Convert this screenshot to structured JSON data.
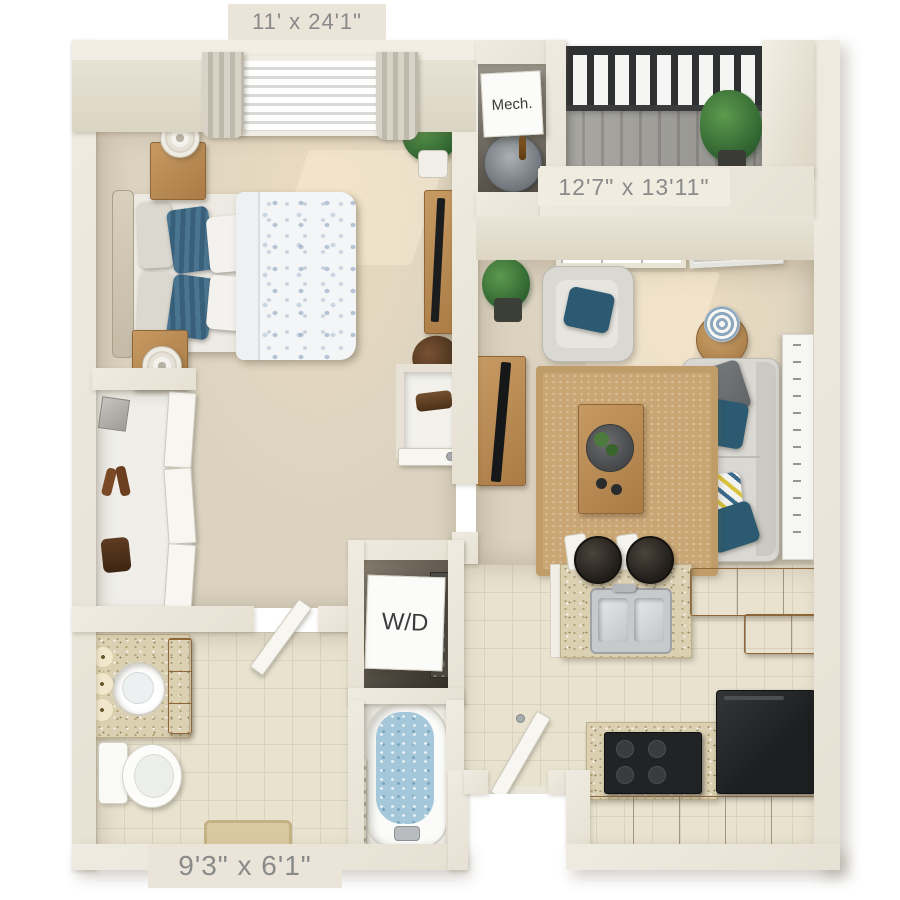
{
  "floorplan": {
    "view": "3D top-down apartment floor plan rendering",
    "dimension_labels": {
      "bedroom": "11' x 24'1\"",
      "living_room": "12'7\" x 13'11\"",
      "bathroom": "9'3\" x 6'1\""
    },
    "room_placards": {
      "mechanical": "Mech.",
      "laundry": "W/D"
    },
    "rooms": [
      {
        "name": "bedroom",
        "furniture": [
          "bed-with-floral-duvet",
          "blue-striped-pillows",
          "headboard",
          "nightstand-with-lamp",
          "second-nightstand-with-lamp",
          "dresser-with-tv",
          "accent-chair",
          "potted-plant",
          "window-with-curtains-and-blinds"
        ]
      },
      {
        "name": "walk-in-closet",
        "furniture": [
          "shelf-with-box",
          "shoes",
          "bag",
          "bifold-doors"
        ]
      },
      {
        "name": "mechanical-closet",
        "furniture": [
          "water-heater"
        ]
      },
      {
        "name": "balcony",
        "furniture": [
          "metal-railing",
          "plank-deck",
          "potted-palm"
        ]
      },
      {
        "name": "living-room",
        "furniture": [
          "window",
          "louvered-hvac-door",
          "armchair-with-teal-pillow",
          "round-side-table-with-lamp",
          "sofa-with-pillows",
          "wall-art-panel",
          "jute-area-rug",
          "coffee-table-with-tray",
          "tv-console-with-tv",
          "potted-bush"
        ]
      },
      {
        "name": "kitchen",
        "furniture": [
          "granite-peninsula-with-double-sink",
          "two-bar-stools",
          "upper-cabinets",
          "black-range",
          "black-refrigerator",
          "base-cabinets"
        ]
      },
      {
        "name": "laundry-closet",
        "furniture": [
          "stacked-washer-dryer"
        ]
      },
      {
        "name": "bathroom",
        "furniture": [
          "granite-vanity-with-round-sink",
          "candles",
          "toilet",
          "bath-mat",
          "bathtub-with-water",
          "shower-curtain",
          "door"
        ]
      },
      {
        "name": "entry",
        "furniture": [
          "front-door"
        ]
      }
    ],
    "colors": {
      "background": "#ffffff",
      "walls": "#eae5d9",
      "carpet": "#dbd2c0",
      "tile": "#e8e2cf",
      "closet_floor": "#efeee8",
      "balcony_deck": "#a3a29e",
      "railing": "#2f3032",
      "wood": "#bd8c51",
      "granite": "#dbd0b2",
      "sofa": "#dad8d3",
      "pillow_blue": "#47718e",
      "pillow_teal": "#2b5a71",
      "rug": "#c9a674",
      "bath_water": "#a4c8da",
      "appliance_black": "#242526",
      "plant_green": "#3f7d3a",
      "label_text": "#8a8a8a",
      "placard_text": "#3c3c3c"
    }
  }
}
